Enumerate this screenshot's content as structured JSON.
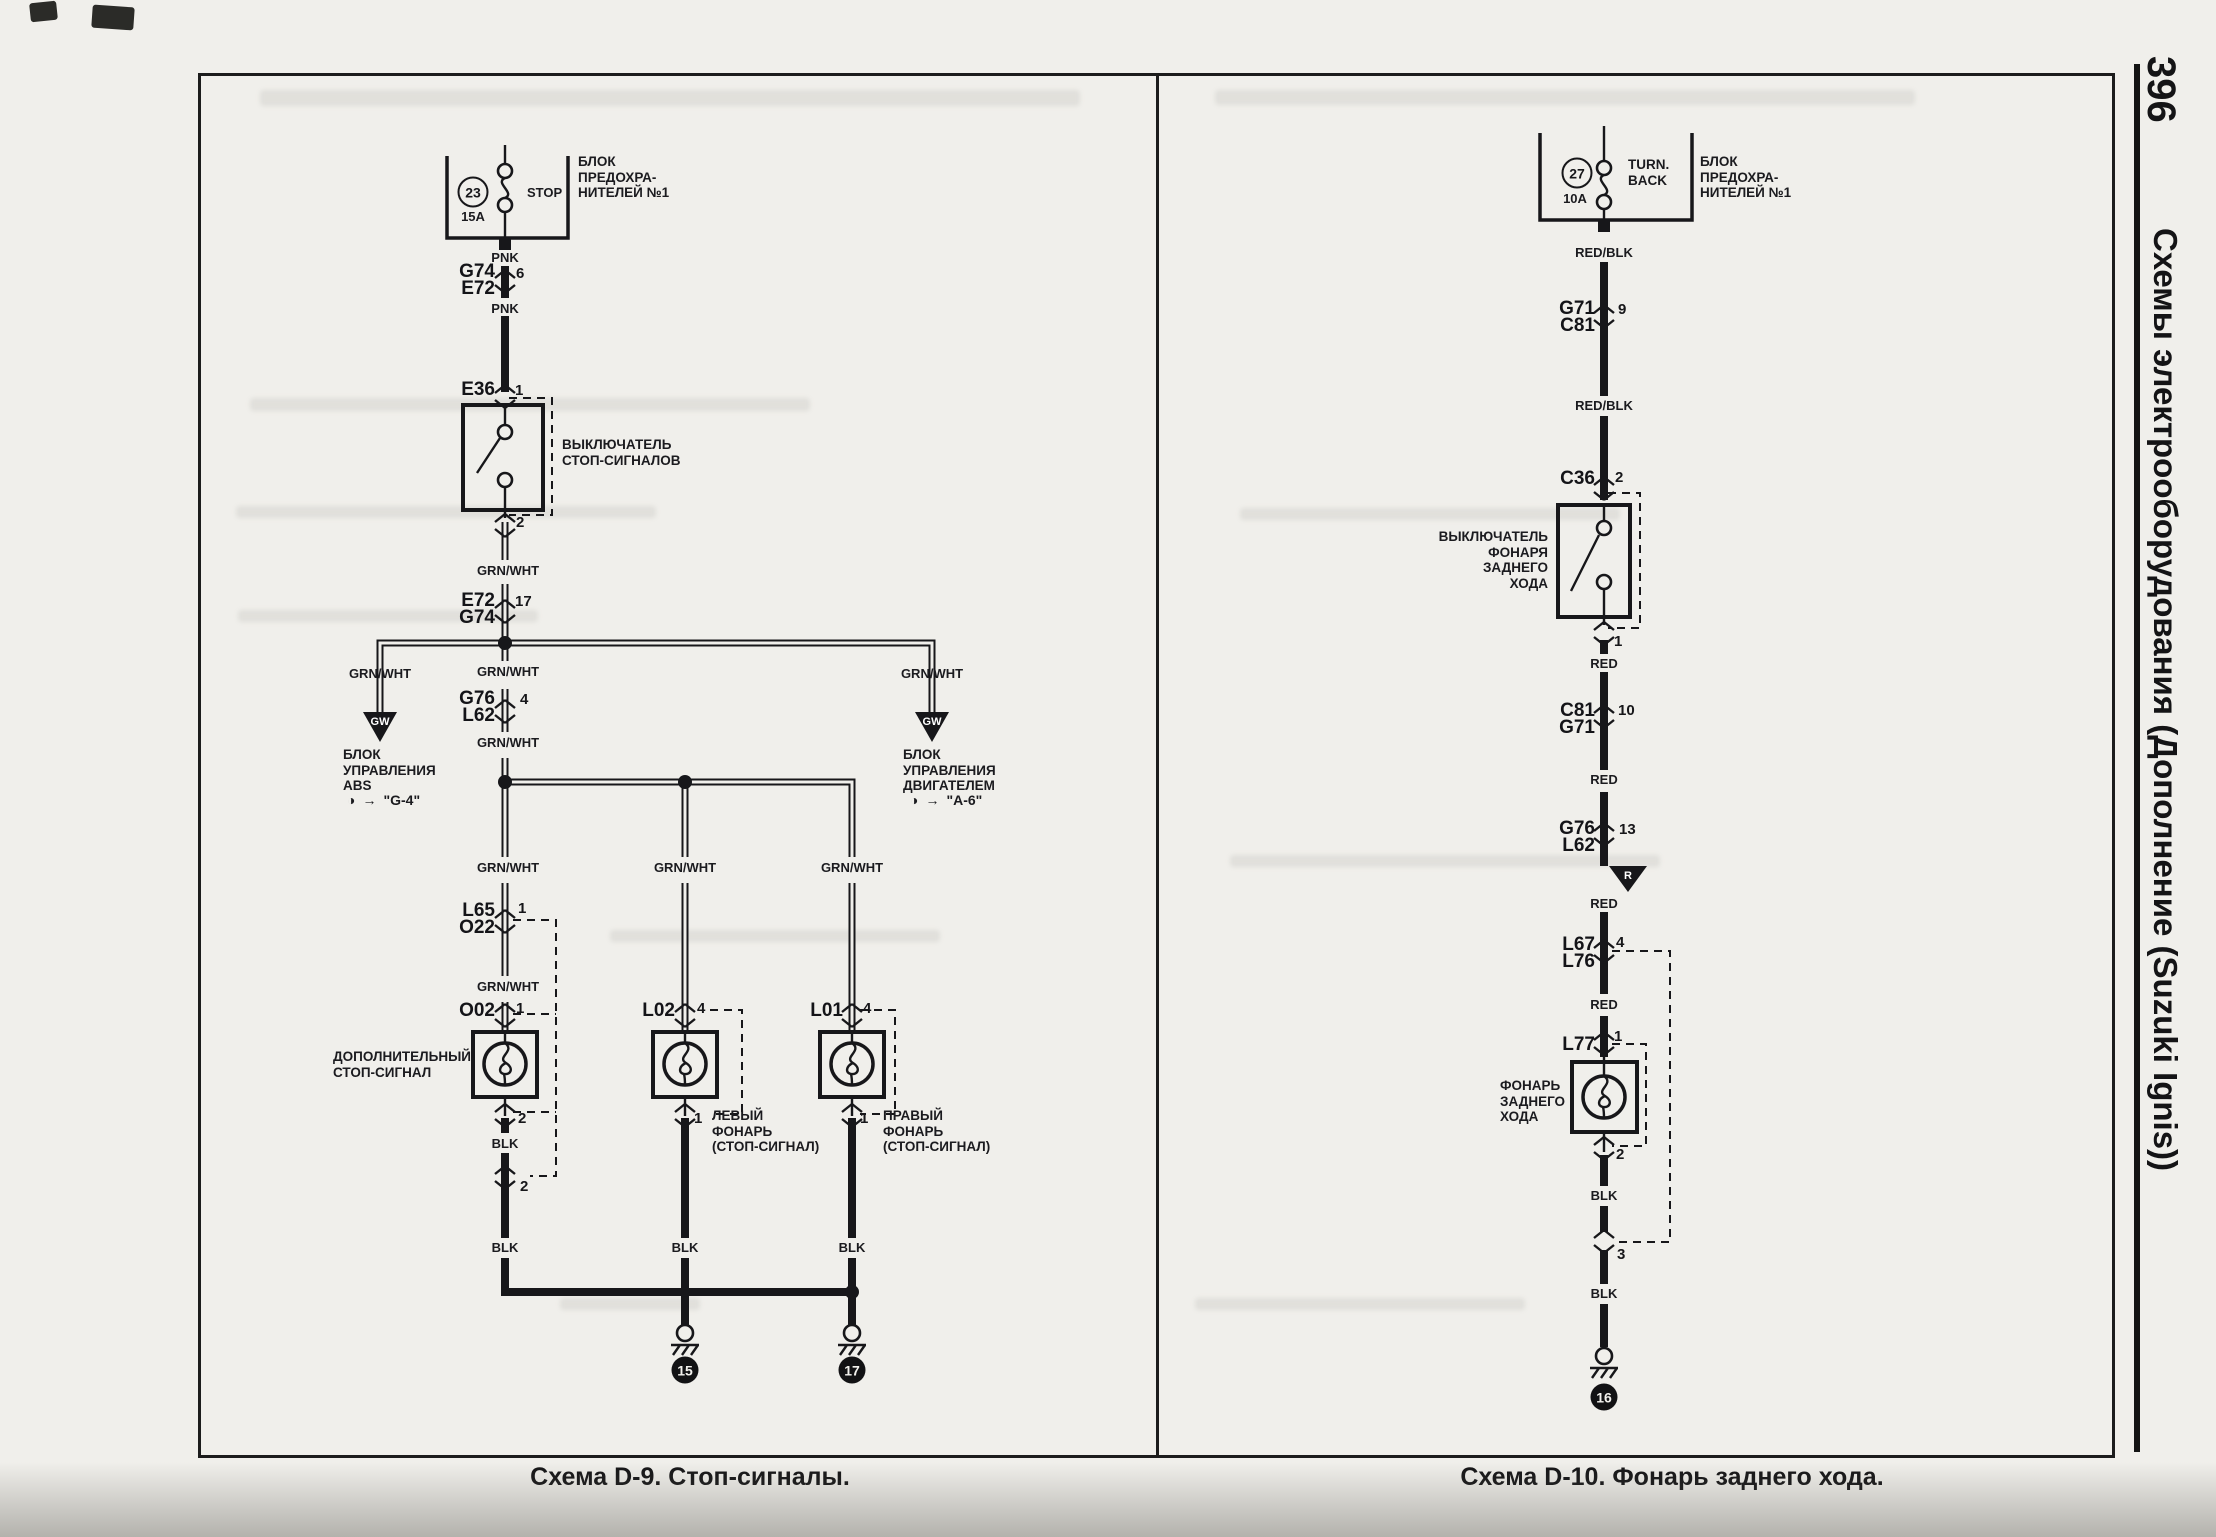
{
  "page_number": "396",
  "sidebar_title": "Схемы электрооборудования (Дополнение (Suzuki Ignis))",
  "d9": {
    "caption": "Схема D-9. Стоп-сигналы.",
    "fuse": {
      "number": "23",
      "amps": "15A",
      "name": "STOP",
      "block": [
        "БЛОК",
        "ПРЕДОХРА-",
        "НИТЕЛЕЙ №1"
      ]
    },
    "wire_labels": [
      "PNK",
      "PNK",
      "GRN/WHT",
      "GRN/WHT",
      "GRN/WHT",
      "GRN/WHT",
      "GRN/WHT",
      "GRN/WHT",
      "GRN/WHT",
      "GRN/WHT",
      "GRN/WHT",
      "BLK",
      "BLK",
      "BLK",
      "BLK"
    ],
    "connectors": {
      "c1": {
        "l1": "G74",
        "l2": "E72",
        "pin": "6"
      },
      "c2": {
        "l1": "E36",
        "pin": "1"
      },
      "c2b": {
        "pin": "2"
      },
      "c3": {
        "l1": "E72",
        "l2": "G74",
        "pin": "17"
      },
      "c4": {
        "l1": "G76",
        "l2": "L62",
        "pin": "4"
      },
      "c5": {
        "l1": "L65",
        "l2": "O22",
        "pin": "1"
      },
      "c6": {
        "l1": "O02",
        "pin": "1"
      },
      "c6b": {
        "pin": "2"
      },
      "c6c": {
        "pin": "2"
      },
      "c7": {
        "l1": "L02",
        "pin": "4"
      },
      "c7b": {
        "pin": "1"
      },
      "c8": {
        "l1": "L01",
        "pin": "4"
      },
      "c8b": {
        "pin": "1"
      }
    },
    "arrow_label": "GW",
    "ref_icon": "◑",
    "ref_arrow": "→",
    "devices": {
      "stop_switch": [
        "ВЫКЛЮЧАТЕЛЬ",
        "СТОП-СИГНАЛОВ"
      ],
      "abs": [
        "БЛОК",
        "УПРАВЛЕНИЯ",
        "ABS"
      ],
      "abs_ref": "\"G-4\"",
      "ecm": [
        "БЛОК",
        "УПРАВЛЕНИЯ",
        "ДВИГАТЕЛЕМ"
      ],
      "ecm_ref": "\"A-6\"",
      "aux_stop": [
        "ДОПОЛНИТЕЛЬНЫЙ",
        "СТОП-СИГНАЛ"
      ],
      "left_lamp": [
        "ЛЕВЫЙ",
        "ФОНАРЬ",
        "(СТОП-СИГНАЛ)"
      ],
      "right_lamp": [
        "ПРАВЫЙ",
        "ФОНАРЬ",
        "(СТОП-СИГНАЛ)"
      ]
    },
    "grounds": [
      "15",
      "17"
    ]
  },
  "d10": {
    "caption": "Схема D-10. Фонарь заднего хода.",
    "fuse": {
      "number": "27",
      "amps": "10A",
      "name": [
        "TURN.",
        "BACK"
      ],
      "block": [
        "БЛОК",
        "ПРЕДОХРА-",
        "НИТЕЛЕЙ №1"
      ]
    },
    "wire_labels": [
      "RED/BLK",
      "RED/BLK",
      "RED",
      "RED",
      "RED",
      "RED",
      "BLK",
      "BLK"
    ],
    "connectors": {
      "c1": {
        "l1": "G71",
        "l2": "C81",
        "pin": "9"
      },
      "c2": {
        "l1": "C36",
        "pin": "2"
      },
      "c2b": {
        "pin": "1"
      },
      "c3": {
        "l1": "C81",
        "l2": "G71",
        "pin": "10"
      },
      "c4": {
        "l1": "G76",
        "l2": "L62",
        "pin": "13"
      },
      "c5": {
        "l1": "L67",
        "l2": "L76",
        "pin": "4"
      },
      "c6": {
        "l1": "L77",
        "pin": "1"
      },
      "c6b": {
        "pin": "2"
      },
      "c6c": {
        "pin": "3"
      }
    },
    "arrow_label": "R",
    "devices": {
      "reverse_switch": [
        "ВЫКЛЮЧАТЕЛЬ",
        "ФОНАРЯ",
        "ЗАДНЕГО",
        "ХОДА"
      ],
      "reverse_lamp": [
        "ФОНАРЬ",
        "ЗАДНЕГО",
        "ХОДА"
      ]
    },
    "ground": "16"
  }
}
